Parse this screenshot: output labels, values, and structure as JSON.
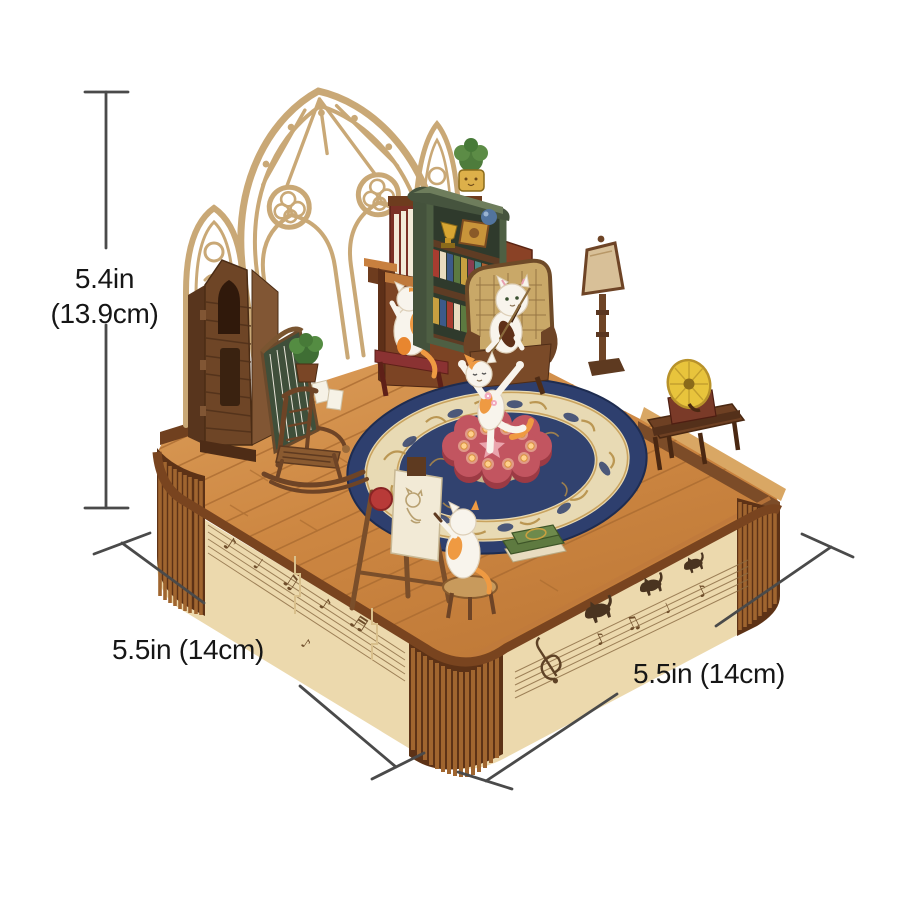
{
  "annotations": {
    "height": {
      "line1": "5.4in",
      "line2": "(13.9cm)"
    },
    "width_left": "5.5in (14cm)",
    "width_right": "5.5in (14cm)"
  },
  "colors": {
    "background": "#ffffff",
    "dimension_line": "#4a4a4a",
    "label_text": "#161616",
    "wood_floor": "#c9813e",
    "base_panel": "#ecd9ad",
    "base_rim": "#79441f",
    "corner_slats": "#a0652f",
    "tracery": "#c9a876",
    "pillar": "#6e4526",
    "organ": "#7c4424",
    "organ_keys": "#f5f1e6",
    "bookcase_green": "#5c6b4e",
    "rug_navy": "#2e3f6e",
    "rug_cream": "#e8dab4",
    "stage_pink": "#c25560",
    "stage_lights": "#ffd08c",
    "cat_white": "#f8f4ec",
    "cat_orange": "#ef9a42",
    "gramophone_horn": "#e8c43c",
    "books_green": "#5e7a40",
    "lamp_shade": "#d8c098",
    "trophy_gold": "#d8a632"
  }
}
